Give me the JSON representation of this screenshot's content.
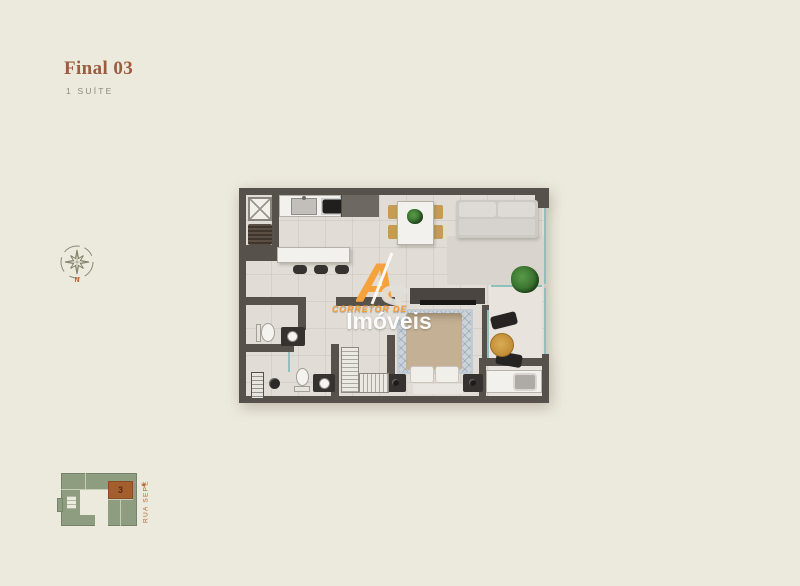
{
  "page": {
    "background_color": "#ECE9DD"
  },
  "header": {
    "title": "Final 03",
    "subtitle": "1 SUÍTE"
  },
  "compass": {
    "north_label": "N"
  },
  "watermark": {
    "logo_letter_a": "A",
    "logo_letter_s": "S",
    "tagline": "CORRETOR DE",
    "brand": "Imóveis"
  },
  "site_plan": {
    "unit_number": "3",
    "street_label": "RUA SEPÉ"
  },
  "colors": {
    "title_brown": "#9C5C3F",
    "wall_dark": "#57514C",
    "floor_light": "#E1DDD6",
    "glass_teal": "#8FC0BC",
    "logo_orange": "#F6A23C",
    "site_green": "#8E9C80",
    "site_unit_orange": "#A45D2C",
    "street_label_orange": "#B06A35"
  }
}
